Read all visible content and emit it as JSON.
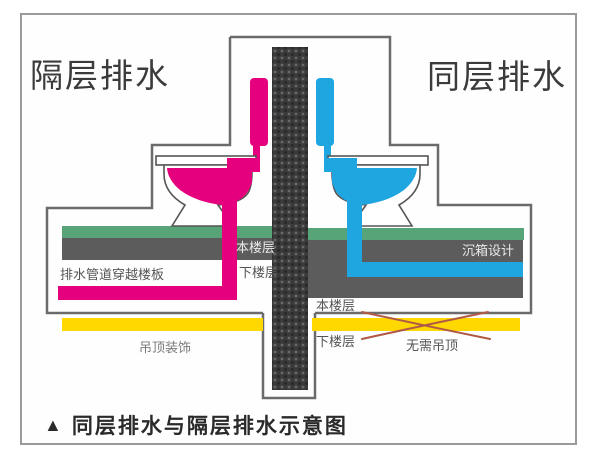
{
  "colors": {
    "magenta": "#e5007d",
    "blue": "#1fa6e0",
    "green": "#57a478",
    "slab": "#5c5c5c",
    "yellow": "#ffd800",
    "column": "#3a3a3a",
    "column-dot": "#686868",
    "outline": "#6b6b6b",
    "frame": "#9a9a9a",
    "cross": "#b05a45"
  },
  "diagram": {
    "title_left": "隔层排水",
    "title_right": "同层排水",
    "left_section": {
      "floor_this": "本楼层",
      "floor_below": "下楼层",
      "pipe_note": "排水管道穿越楼板",
      "ceiling_note": "吊顶装饰"
    },
    "right_section": {
      "sunken_box": "沉箱设计",
      "floor_this": "本楼层",
      "floor_below": "下楼层",
      "no_ceiling_note": "无需吊顶"
    }
  },
  "caption": {
    "marker": "▲",
    "text": "同层排水与隔层排水示意图"
  }
}
